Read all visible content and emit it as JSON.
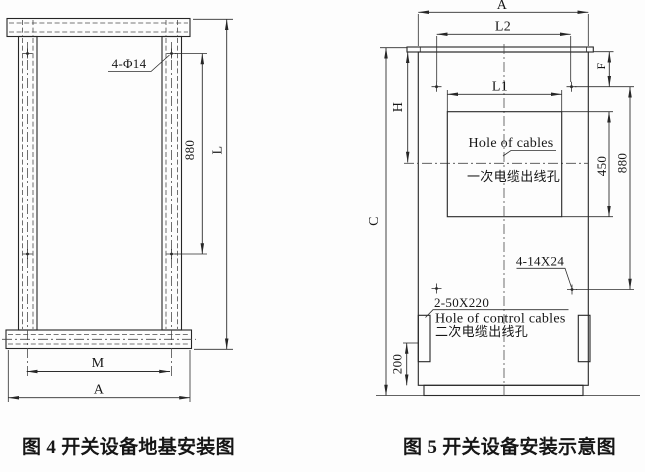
{
  "figure4": {
    "caption": "图 4  开关设备地基安装图",
    "labels": {
      "holes": "4-Φ14",
      "dim_880": "880",
      "dim_L": "L",
      "dim_M": "M",
      "dim_A": "A"
    }
  },
  "figure5": {
    "caption": "图 5  开关设备安装示意图",
    "labels": {
      "dim_A": "A",
      "dim_L2": "L2",
      "dim_L1": "L1",
      "dim_H": "H",
      "dim_C": "C",
      "dim_F": "F",
      "dim_450": "450",
      "dim_880": "880",
      "dim_200": "200",
      "mount_holes": "4-14X24",
      "control_slots": "2-50X220",
      "cable_hole_en": "Hole of cables",
      "cable_hole_zh": "一次电缆出线孔",
      "control_hole_en": "Hole of control cables",
      "control_hole_zh": "二次电缆出线孔"
    }
  },
  "colors": {
    "line": "#262626",
    "text": "#161616",
    "background": "#fdfdfd"
  }
}
